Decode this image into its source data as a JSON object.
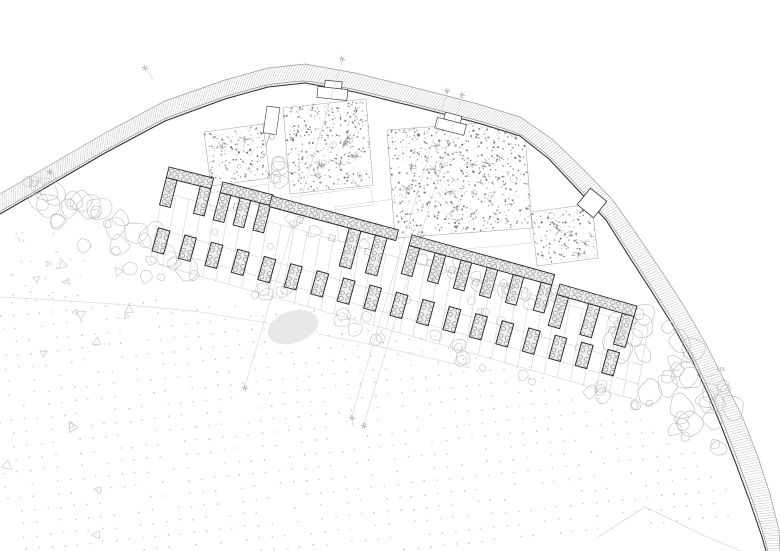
{
  "title": "architectural-site-plan",
  "canvas": {
    "w": 780,
    "h": 551,
    "bg": "#ffffff"
  },
  "colors": {
    "ink": "#1a1a1a",
    "wallStroke": "#222222",
    "hatch": "#c6c6c6",
    "bandOuter": "#9b9b9b",
    "bandInner": "#2e2e2e",
    "bandInner2": "#6a6a6a",
    "grid": "#c3c3c3",
    "plotEdge": "#adadad",
    "speckle": [
      "#6e6e6e",
      "#878787",
      "#a0a0a0",
      "#bcbcbc"
    ],
    "tree": "#b9b9b9",
    "rock": "#b4b4b4",
    "dot": "#d3d3d3",
    "faintPath": "#dcdcdc",
    "lamp": "#8a8a8a",
    "terrace": "#cccccc",
    "pond": "#e8e8e8",
    "label": "#9a9a9a",
    "stoneBg": "#f0f0f0",
    "stoneLine": "#555555"
  },
  "seed": 11,
  "band": {
    "inner": [
      [
        0,
        214
      ],
      [
        45,
        188
      ],
      [
        105,
        153
      ],
      [
        165,
        121
      ],
      [
        225,
        99
      ],
      [
        268,
        87
      ],
      [
        305,
        83
      ],
      [
        355,
        92
      ],
      [
        420,
        108
      ],
      [
        478,
        123
      ],
      [
        520,
        136
      ],
      [
        549,
        159
      ],
      [
        578,
        190
      ],
      [
        606,
        220
      ],
      [
        630,
        258
      ],
      [
        652,
        292
      ],
      [
        672,
        324
      ],
      [
        692,
        360
      ],
      [
        708,
        394
      ],
      [
        722,
        428
      ],
      [
        736,
        464
      ],
      [
        750,
        502
      ],
      [
        762,
        537
      ],
      [
        766,
        551
      ]
    ],
    "outer": [
      [
        0,
        194
      ],
      [
        45,
        168
      ],
      [
        105,
        133
      ],
      [
        165,
        101
      ],
      [
        225,
        80
      ],
      [
        268,
        68
      ],
      [
        305,
        64
      ],
      [
        355,
        73
      ],
      [
        420,
        89
      ],
      [
        478,
        104
      ],
      [
        520,
        117
      ],
      [
        552,
        139
      ],
      [
        582,
        168
      ],
      [
        612,
        199
      ],
      [
        638,
        236
      ],
      [
        662,
        272
      ],
      [
        684,
        306
      ],
      [
        706,
        344
      ],
      [
        724,
        380
      ],
      [
        742,
        416
      ],
      [
        757,
        454
      ],
      [
        770,
        494
      ],
      [
        779,
        530
      ],
      [
        780,
        551
      ]
    ],
    "hatchStep": 2.55
  },
  "notches": [
    {
      "x": 333,
      "y": 88,
      "a": 6
    },
    {
      "x": 452,
      "y": 121,
      "a": 14.5
    }
  ],
  "gate": {
    "x": 267,
    "y": 106,
    "w": 13,
    "h": 27,
    "a": 8,
    "knob": [
      272,
      137
    ]
  },
  "doorway": {
    "cx": 592,
    "cy": 203,
    "s": 21,
    "a": 39
  },
  "plots": [
    {
      "pts": [
        [
          204,
          132
        ],
        [
          263,
          124
        ],
        [
          270,
          178
        ],
        [
          211,
          186
        ]
      ],
      "stars": 2,
      "bushes": 2
    },
    {
      "pts": [
        [
          283,
          108
        ],
        [
          366,
          99
        ],
        [
          373,
          185
        ],
        [
          290,
          194
        ]
      ],
      "stars": 6,
      "bushes": 4
    },
    {
      "pts": [
        [
          387,
          130
        ],
        [
          524,
          120
        ],
        [
          532,
          228
        ],
        [
          395,
          238
        ]
      ],
      "stars": 8,
      "bushes": 6
    },
    {
      "pts": [
        [
          531,
          212
        ],
        [
          592,
          204
        ],
        [
          598,
          258
        ],
        [
          537,
          266
        ]
      ],
      "stars": 3,
      "bushes": 2
    }
  ],
  "speckleDensity": 0.05,
  "terraces": [
    [
      [
        209,
        193
      ],
      [
        268,
        184
      ],
      [
        270,
        202
      ],
      [
        211,
        211
      ]
    ],
    [
      [
        291,
        197
      ],
      [
        371,
        187
      ],
      [
        373,
        205
      ],
      [
        293,
        215
      ]
    ],
    [
      [
        335,
        207
      ],
      [
        417,
        196
      ],
      [
        421,
        231
      ],
      [
        339,
        242
      ]
    ],
    [
      [
        398,
        237
      ],
      [
        529,
        225
      ],
      [
        532,
        243
      ],
      [
        401,
        255
      ]
    ]
  ],
  "grid": {
    "top": [
      [
        163,
        192
      ],
      [
        648,
        327
      ]
    ],
    "bottom": [
      [
        150,
        262
      ],
      [
        636,
        400
      ]
    ],
    "n": 37,
    "rows": [
      0,
      0.52,
      0.78,
      1
    ]
  },
  "modules": [
    {
      "x": 169,
      "y": 167,
      "a": 14,
      "w": 46,
      "lw": 11,
      "lh": 28,
      "legs": [
        0,
        35
      ]
    },
    {
      "x": 223,
      "y": 182,
      "a": 14.5,
      "w": 52,
      "lw": 11,
      "lh": 28,
      "legs": [
        0,
        20.5,
        41
      ]
    },
    {
      "x": 272,
      "y": 196,
      "a": 15,
      "w": 131,
      "lw": 12,
      "lh": 39,
      "legs": [
        83,
        110
      ]
    },
    {
      "x": 412,
      "y": 235,
      "a": 15.5,
      "w": 148,
      "lw": 11,
      "lh": 29,
      "legs": [
        0,
        27,
        54,
        81,
        108,
        137
      ]
    },
    {
      "x": 560,
      "y": 284,
      "a": 16,
      "w": 80,
      "lw": 12,
      "lh": 32,
      "legs": [
        0,
        33,
        68
      ]
    }
  ],
  "piers": {
    "start": [
      161,
      241
    ],
    "step": [
      26.45,
      7.15
    ],
    "count": 18,
    "w": 12,
    "h": 24,
    "a": 15.5
  },
  "planters": [
    [
      237,
      207
    ],
    [
      300,
      220
    ],
    [
      332,
      238
    ],
    [
      368,
      252
    ],
    [
      430,
      263
    ],
    [
      452,
      270
    ],
    [
      476,
      282
    ],
    [
      545,
      303
    ],
    [
      588,
      318
    ],
    [
      612,
      330
    ]
  ],
  "bayTrees": {
    "line": [
      [
        172,
        228
      ],
      [
        600,
        346
      ]
    ],
    "spread": 9,
    "count": 12,
    "rmin": 2.5,
    "rmax": 4.5
  },
  "vegetation": [
    {
      "name": "left-flank-trees",
      "line": [
        [
          28,
          192
        ],
        [
          168,
          262
        ]
      ],
      "spread": 26,
      "count": 30,
      "rmin": 4,
      "rmax": 13
    },
    {
      "name": "upper-row-trees",
      "line": [
        [
          225,
          196
        ],
        [
          645,
          327
        ]
      ],
      "spread": 11,
      "count": 22,
      "rmin": 3.5,
      "rmax": 8
    },
    {
      "name": "mid-trees",
      "line": [
        [
          415,
          252
        ],
        [
          540,
          300
        ]
      ],
      "spread": 10,
      "count": 9,
      "rmin": 4,
      "rmax": 7
    },
    {
      "name": "lower-row-trees",
      "line": [
        [
          158,
          266
        ],
        [
          648,
          408
        ]
      ],
      "spread": 13,
      "count": 30,
      "rmin": 3.5,
      "rmax": 8
    },
    {
      "name": "grove",
      "line": [
        [
          268,
          150
        ],
        [
          292,
          190
        ]
      ],
      "spread": 8,
      "count": 6,
      "rmin": 5,
      "rmax": 9
    },
    {
      "name": "right-rock-cluster",
      "poly": [
        [
          612,
          300
        ],
        [
          668,
          318
        ],
        [
          708,
          352
        ],
        [
          736,
          408
        ],
        [
          724,
          452
        ],
        [
          688,
          444
        ],
        [
          648,
          408
        ],
        [
          616,
          352
        ]
      ],
      "count": 40,
      "rmin": 4,
      "rmax": 14
    }
  ],
  "pond": {
    "cx": 293,
    "cy": 327,
    "rx": 26,
    "ry": 16,
    "a": -18
  },
  "dotField": {
    "spacing": 13,
    "angle": -6,
    "r": 0.85,
    "skip": 0.17,
    "poly": [
      [
        0,
        291
      ],
      [
        140,
        298
      ],
      [
        300,
        307
      ],
      [
        430,
        331
      ],
      [
        545,
        372
      ],
      [
        645,
        418
      ],
      [
        722,
        472
      ],
      [
        748,
        551
      ],
      [
        0,
        551
      ]
    ]
  },
  "triangles": {
    "count": 16,
    "x": [
      4,
      150
    ],
    "y": [
      246,
      540
    ],
    "smin": 4.5,
    "smax": 9
  },
  "specks": {
    "count": 26,
    "x": [
      2,
      97
    ],
    "y": [
      232,
      302
    ]
  },
  "groundPaths": [
    "M0,297 Q120,303 200,312 Q260,322 318,331",
    "M598,537 L645,507 L705,536 L741,551",
    "M318,334 Q400,350 470,368"
  ],
  "lamps": [
    [
      342,
      59
    ],
    [
      447,
      91
    ],
    [
      462,
      95
    ],
    [
      145,
      68
    ],
    [
      50,
      172
    ],
    [
      245,
      388
    ],
    [
      352,
      418
    ],
    [
      364,
      426
    ]
  ],
  "lampLeaders": [
    [
      147,
      70,
      153,
      79
    ],
    [
      52,
      174,
      58,
      182
    ]
  ],
  "sectionLines": [
    [
      342,
      61,
      245,
      386
    ],
    [
      447,
      93,
      352,
      416
    ],
    [
      462,
      97,
      364,
      424
    ]
  ],
  "annotations": {
    "elevation": {
      "text": "+15",
      "x": 716,
      "y": 368,
      "leader": [
        706,
        377,
        715,
        374
      ]
    }
  }
}
